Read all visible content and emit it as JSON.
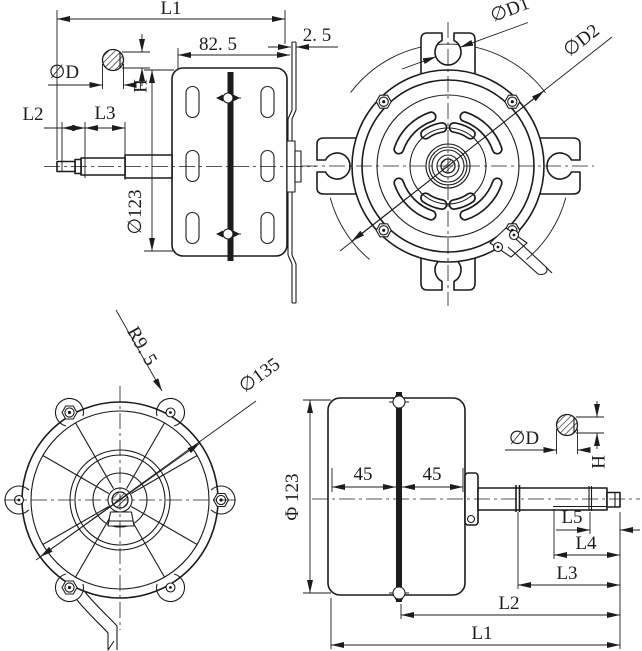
{
  "style": {
    "ink": "#1c1c1c",
    "background": "#ffffff"
  },
  "views": {
    "top_left": {
      "title": "side-view-shaft-left",
      "dims": {
        "l1": "L1",
        "width_825": "82. 5",
        "plate_25": "2. 5",
        "dia_d": "∅D",
        "h": "H",
        "l2": "L2",
        "l3": "L3",
        "dia_123": "∅123"
      }
    },
    "top_right": {
      "title": "front-view",
      "dims": {
        "dia_d1": "∅D1",
        "dia_d2": "∅D2"
      }
    },
    "bottom_left": {
      "title": "rear-view",
      "dims": {
        "radius_95": "R9. 5",
        "dia_135": "∅135"
      }
    },
    "bottom_right": {
      "title": "side-view-shaft-right",
      "dims": {
        "phi_123": "Φ 123",
        "left_45": "45",
        "right_45": "45",
        "dia_d": "∅D",
        "h": "H",
        "l5": "L5",
        "l4": "L4",
        "l3": "L3",
        "l2": "L2",
        "l1": "L1"
      }
    }
  }
}
